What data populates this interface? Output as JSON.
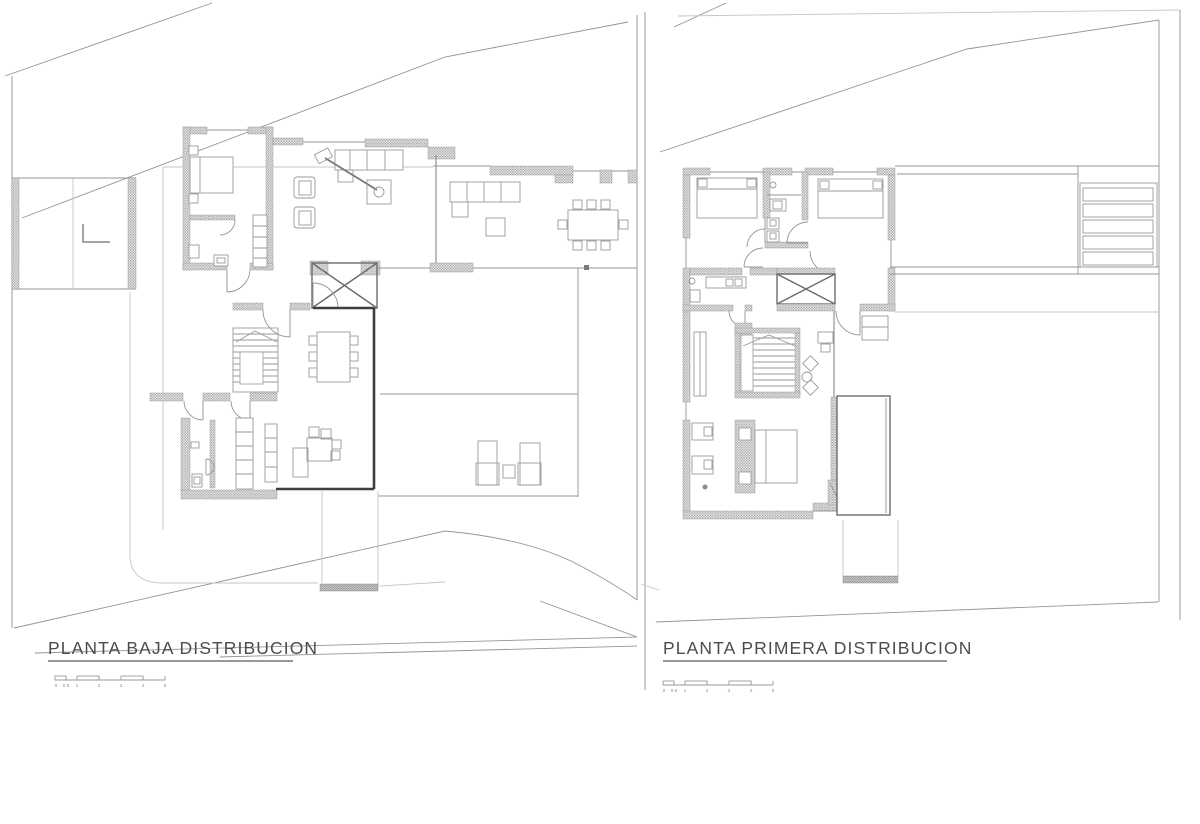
{
  "plans": {
    "ground": {
      "title": "PLANTA BAJA DISTRIBUCION"
    },
    "first": {
      "title": "PLANTA PRIMERA DISTRIBUCION"
    }
  },
  "scale_bar": {
    "labels": [
      "0",
      "0.5",
      "1",
      "2",
      "3",
      "4",
      "5"
    ]
  },
  "colors": {
    "background": "#ffffff",
    "line_dark": "#3f3f3f",
    "line_medium": "#8e8e8e",
    "wall_hatch": "#9a9a9a",
    "title_text": "#4c4c4c"
  }
}
